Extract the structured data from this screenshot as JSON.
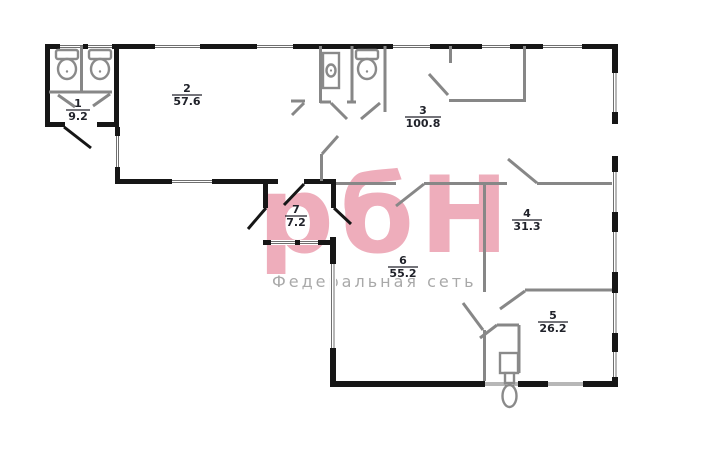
{
  "watermark": {
    "logo": "рбН",
    "subtitle": "Федеральная сеть",
    "logo_color": "#eeadbb",
    "subtitle_color": "#a9a9a9"
  },
  "rooms": {
    "r1": {
      "number": "1",
      "area": "9.2"
    },
    "r2": {
      "number": "2",
      "area": "57.6"
    },
    "r3": {
      "number": "3",
      "area": "100.8"
    },
    "r4": {
      "number": "4",
      "area": "31.3"
    },
    "r5": {
      "number": "5",
      "area": "26.2"
    },
    "r6": {
      "number": "6",
      "area": "55.2"
    },
    "r7": {
      "number": "7",
      "area": "7.2"
    }
  },
  "colors": {
    "exterior_wall": "#161616",
    "partition": "#878787",
    "label_text": "#20222a",
    "background": "#ffffff"
  }
}
